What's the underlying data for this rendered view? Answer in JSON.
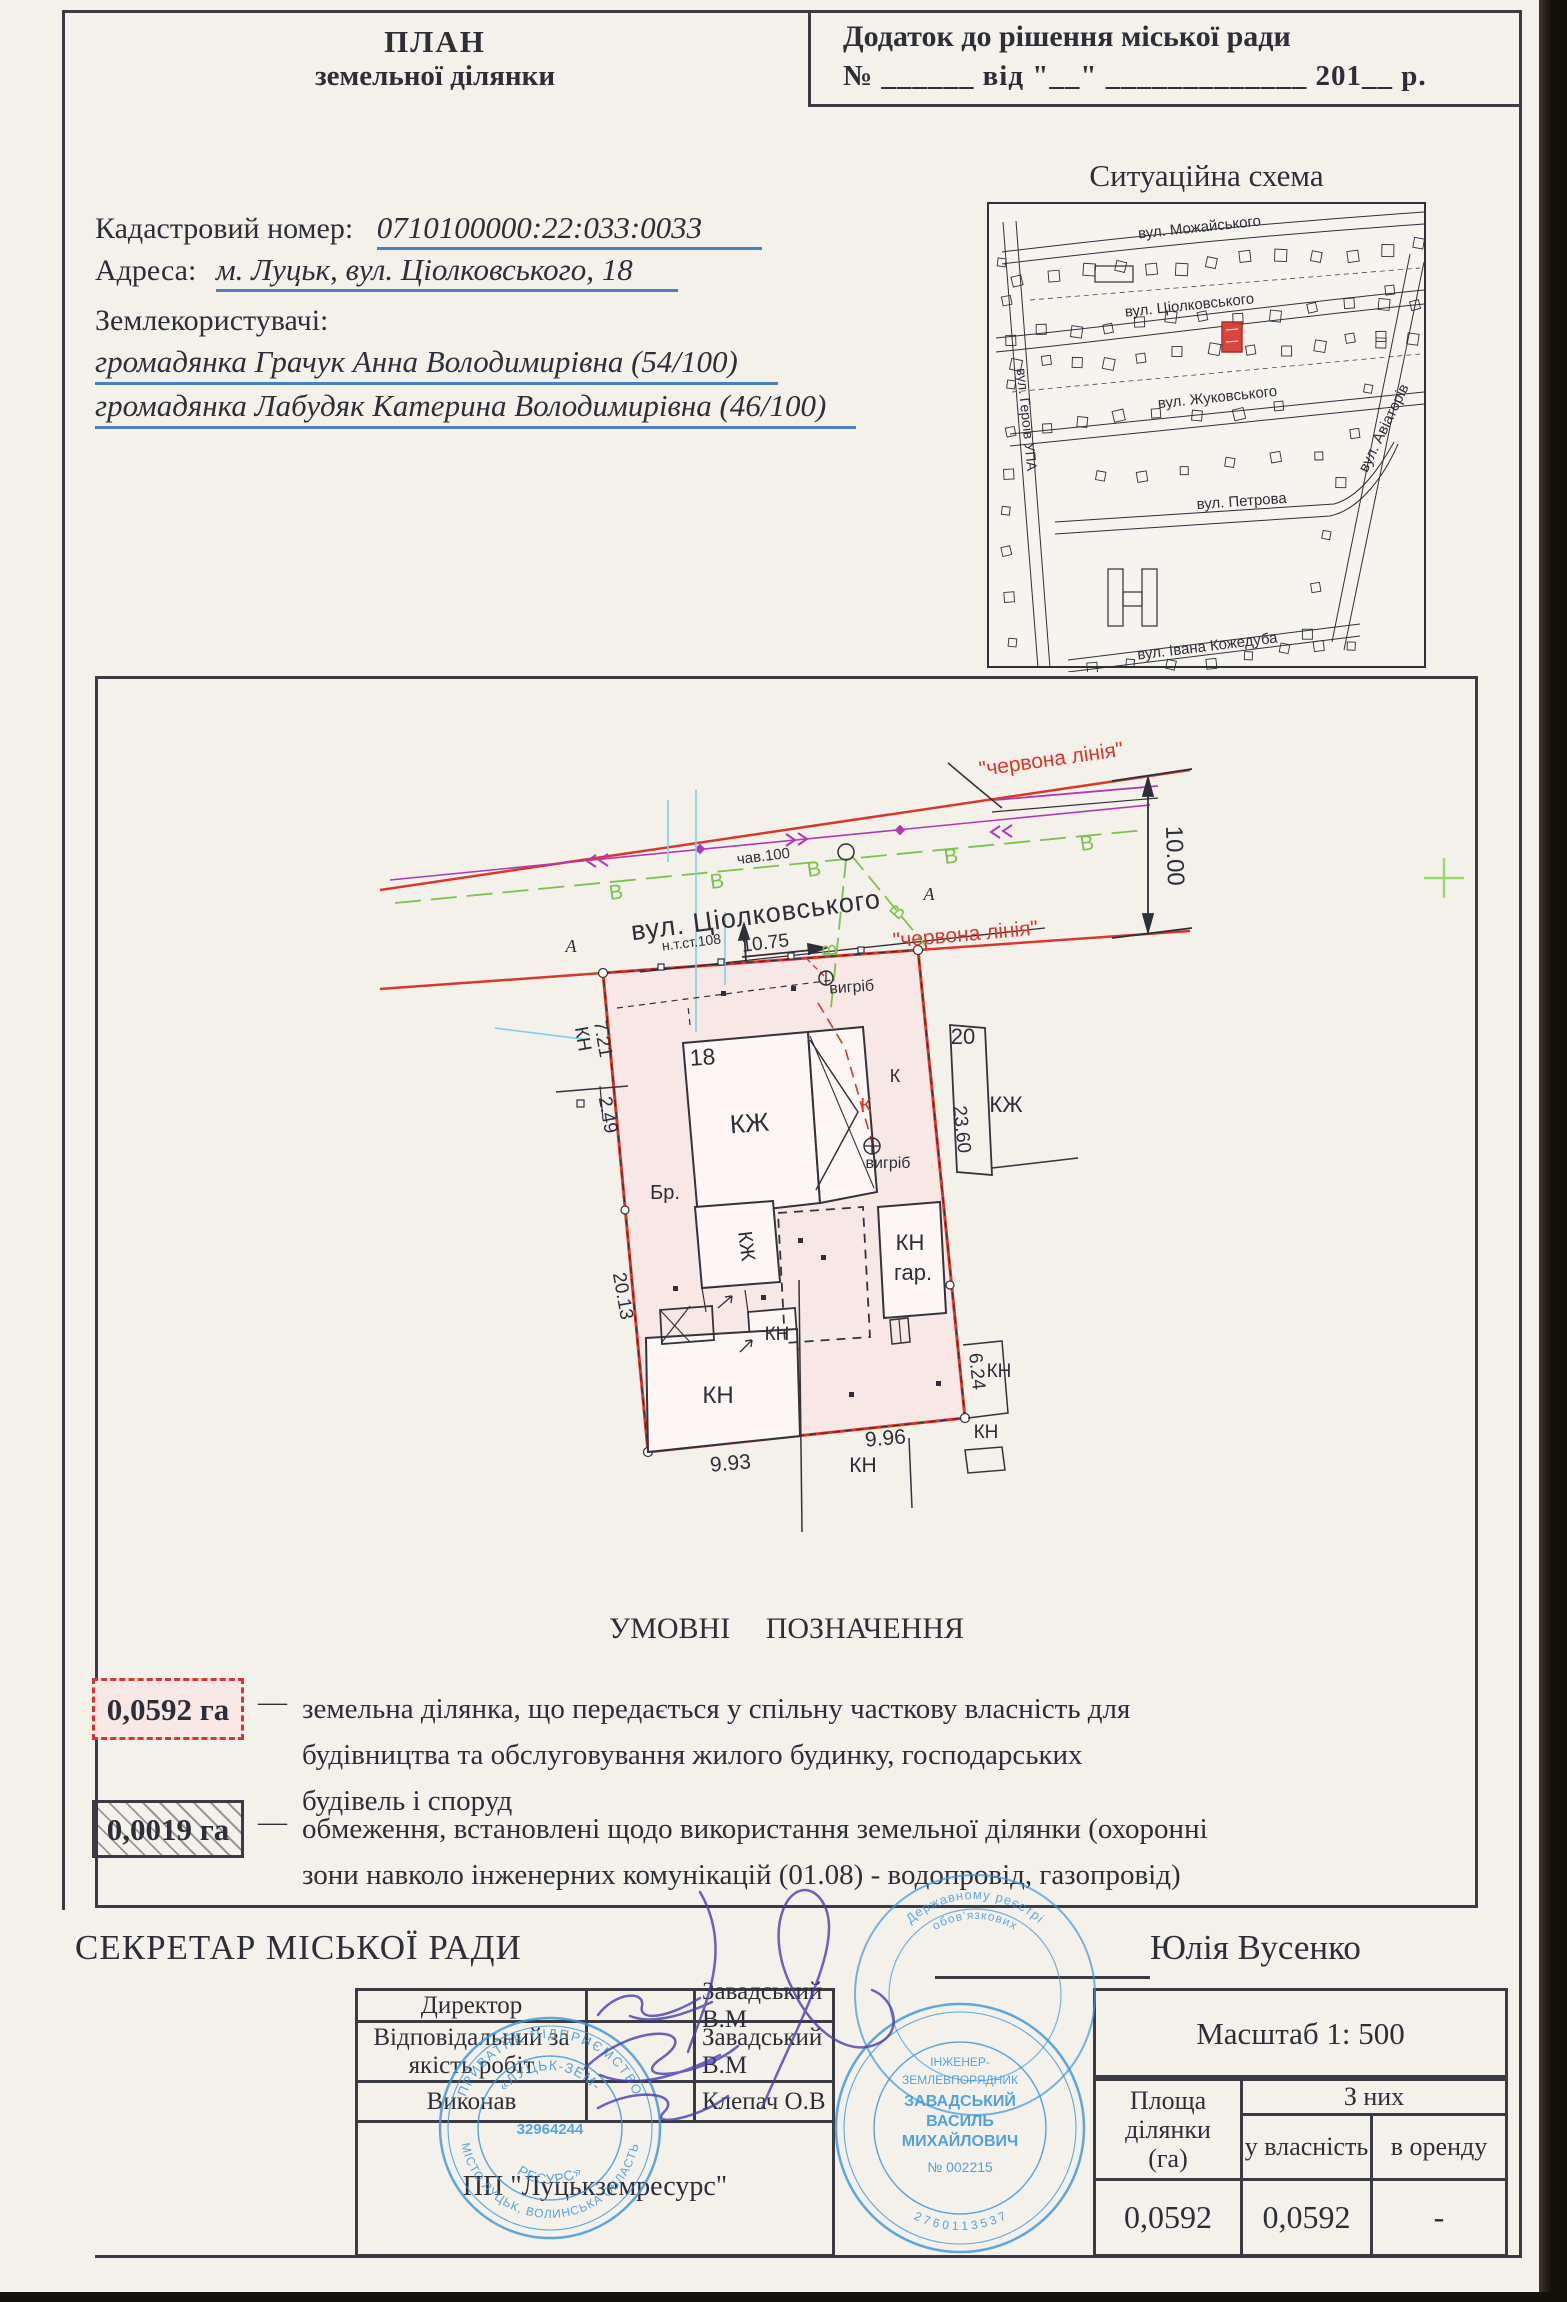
{
  "colors": {
    "red": "#d8382c",
    "green": "#7cc24e",
    "blue": "#4d7fc0",
    "ink": "#2e2e38",
    "line": "#3b3b45",
    "stampblue": "#3f97d8",
    "sigviolet": "#4a3cae",
    "pink": "#f7e7e5"
  },
  "header": {
    "title1": "ПЛАН",
    "title2": "земельної ділянки",
    "appendix1": "Додаток до рішення  міської ради",
    "appendix2": "№ ______ від \"__\" _____________ 201__ р."
  },
  "info": {
    "cadastral_label": "Кадастровий номер:",
    "cadastral_value": "0710100000:22:033:0033",
    "address_label": "Адреса:",
    "address_value": "м. Луцьк, вул. Ціолковського, 18",
    "landusers_label": "Землекористувачі:",
    "landuser1": "громадянка Грачук Анна Володимирівна (54/100)",
    "landuser2": "громадянка Лабудяк Катерина Володимирівна (46/100)"
  },
  "scheme": {
    "title": "Ситуаційна схема",
    "labels": [
      {
        "t": "вул. Можайського",
        "x": 1200,
        "y": 232,
        "r": -6,
        "s": 15,
        "n": "street-mozhayskogo"
      },
      {
        "t": "вул. Ціолковського",
        "x": 1190,
        "y": 310,
        "r": -6,
        "s": 15,
        "n": "street-tsiolkovskogo"
      },
      {
        "t": "вул. Жуковського",
        "x": 1218,
        "y": 402,
        "r": -6,
        "s": 15,
        "n": "street-zhukovskogo"
      },
      {
        "t": "вул. Петрова",
        "x": 1242,
        "y": 506,
        "r": -4,
        "s": 15,
        "n": "street-petrova"
      },
      {
        "t": "вул. Івана Кожедуба",
        "x": 1208,
        "y": 651,
        "r": -7,
        "s": 15,
        "n": "street-kozheduba"
      },
      {
        "t": "вул. Героїв УПА",
        "x": 1022,
        "y": 420,
        "r": 84,
        "s": 14,
        "n": "street-geroiv-upa"
      },
      {
        "t": "вул. Авіаторів",
        "x": 1388,
        "y": 430,
        "r": -64,
        "s": 15,
        "n": "street-aviatoriv"
      }
    ]
  },
  "plan": {
    "labels": [
      {
        "t": "\"червона лінія\"",
        "x": 1052,
        "y": 766,
        "r": -8,
        "s": 21,
        "c": "red",
        "n": "red-line-label-top"
      },
      {
        "t": "\"червона лінія\"",
        "x": 966,
        "y": 941,
        "r": -5,
        "s": 21,
        "c": "red",
        "n": "red-line-label-bottom"
      },
      {
        "t": "10.00",
        "x": 1167,
        "y": 856,
        "r": 88,
        "s": 24,
        "n": "dim-10-00"
      },
      {
        "t": "вул. Ціолковського",
        "x": 757,
        "y": 924,
        "r": -7.5,
        "s": 27,
        "ls": 1,
        "n": "plan-street-name"
      },
      {
        "t": "чав.100",
        "x": 764,
        "y": 861,
        "r": -7,
        "s": 15,
        "n": "pipe-label"
      },
      {
        "t": "н.т.ст.108",
        "x": 692,
        "y": 947,
        "r": -7,
        "s": 14,
        "n": "net-station-label"
      },
      {
        "t": "10.75",
        "x": 766,
        "y": 949,
        "r": -7,
        "s": 19,
        "n": "dim-10-75"
      },
      {
        "t": "А",
        "x": 571,
        "y": 952,
        "s": 18,
        "i": 1,
        "f": "serif",
        "n": "point-a"
      },
      {
        "t": "А",
        "x": 929,
        "y": 900,
        "s": 18,
        "i": 1,
        "f": "serif",
        "n": "point-a"
      },
      {
        "t": "В",
        "x": 617,
        "y": 899,
        "r": -8,
        "s": 21,
        "c": "green",
        "n": "water-mark"
      },
      {
        "t": "В",
        "x": 718,
        "y": 888,
        "r": -8,
        "s": 21,
        "c": "green",
        "n": "water-mark"
      },
      {
        "t": "В",
        "x": 815,
        "y": 876,
        "r": -8,
        "s": 21,
        "c": "green",
        "n": "water-mark"
      },
      {
        "t": "В",
        "x": 952,
        "y": 863,
        "r": -8,
        "s": 21,
        "c": "green",
        "n": "water-mark"
      },
      {
        "t": "В",
        "x": 1088,
        "y": 850,
        "r": -8,
        "s": 21,
        "c": "green",
        "n": "water-mark"
      },
      {
        "t": "В",
        "x": 836,
        "y": 950,
        "r": -90,
        "s": 19,
        "c": "green",
        "n": "water-mark"
      },
      {
        "t": "В",
        "x": 902,
        "y": 916,
        "r": -48,
        "s": 19,
        "c": "green",
        "n": "water-mark"
      },
      {
        "t": "вигріб",
        "x": 852,
        "y": 992,
        "r": -4,
        "s": 16,
        "n": "cesspool-label"
      },
      {
        "t": "вигріб",
        "x": 888,
        "y": 1168,
        "s": 16,
        "n": "cesspool-label"
      },
      {
        "t": "К",
        "x": 866,
        "y": 1112,
        "s": 20,
        "c": "red",
        "n": "sewer-mark"
      },
      {
        "t": "К",
        "x": 895,
        "y": 1082,
        "s": 18,
        "n": "sewer-mark"
      },
      {
        "t": "18",
        "x": 703,
        "y": 1065,
        "r": -4,
        "s": 23,
        "n": "house-number"
      },
      {
        "t": "КЖ",
        "x": 750,
        "y": 1132,
        "r": -4,
        "s": 26,
        "n": "building-label"
      },
      {
        "t": "КЖ",
        "x": 740,
        "y": 1247,
        "r": 83,
        "s": 20,
        "n": "building-label"
      },
      {
        "t": "Бр.",
        "x": 665,
        "y": 1199,
        "s": 20,
        "n": "pavement-label"
      },
      {
        "t": "КН",
        "x": 777,
        "y": 1340,
        "s": 19,
        "n": "building-label"
      },
      {
        "t": "КН",
        "x": 910,
        "y": 1250,
        "s": 22,
        "n": "building-label"
      },
      {
        "t": "гар.",
        "x": 913,
        "y": 1280,
        "s": 22,
        "n": "garage-label"
      },
      {
        "t": "КН",
        "x": 718,
        "y": 1403,
        "s": 24,
        "n": "building-label"
      },
      {
        "t": "20",
        "x": 963,
        "y": 1044,
        "s": 22,
        "n": "house-number"
      },
      {
        "t": "23.60",
        "x": 956,
        "y": 1130,
        "r": 84,
        "s": 19,
        "n": "dim"
      },
      {
        "t": "КЖ",
        "x": 1006,
        "y": 1112,
        "s": 22,
        "n": "building-label"
      },
      {
        "t": "7.21",
        "x": 597,
        "y": 1040,
        "r": 80,
        "s": 19,
        "n": "dim"
      },
      {
        "t": "КН",
        "x": 577,
        "y": 1040,
        "r": 80,
        "s": 19,
        "n": "building-label"
      },
      {
        "t": "2.49",
        "x": 602,
        "y": 1116,
        "r": 80,
        "s": 19,
        "n": "dim"
      },
      {
        "t": "20.13",
        "x": 617,
        "y": 1297,
        "r": 80,
        "s": 19,
        "n": "dim"
      },
      {
        "t": "6.24",
        "x": 971,
        "y": 1372,
        "r": 84,
        "s": 19,
        "n": "dim"
      },
      {
        "t": "КН",
        "x": 999,
        "y": 1377,
        "s": 19,
        "n": "building-label"
      },
      {
        "t": "9.93",
        "x": 731,
        "y": 1470,
        "r": -5,
        "s": 21,
        "n": "dim"
      },
      {
        "t": "КН",
        "x": 863,
        "y": 1472,
        "s": 21,
        "n": "building-label"
      },
      {
        "t": "9.96",
        "x": 886,
        "y": 1445,
        "r": -5,
        "s": 21,
        "n": "dim"
      },
      {
        "t": "КН",
        "x": 986,
        "y": 1438,
        "s": 19,
        "n": "building-label"
      }
    ]
  },
  "legend": {
    "title": "УМОВНІ ПОЗНАЧЕННЯ",
    "dash": "—",
    "items": [
      {
        "value": "0,0592 га",
        "lines": [
          "земельна ділянка, що передається у спільну часткову власність для",
          "будівництва та обслуговування жилого будинку, господарських",
          "будівель і споруд"
        ]
      },
      {
        "value": "0,0019 га",
        "lines": [
          "обмеження, встановлені щодо використання земельної ділянки (охоронні",
          "зони навколо інженерних комунікацій (01.08) - водопровід, газопровід)"
        ]
      }
    ]
  },
  "footer": {
    "secretary_label": "СЕКРЕТАР МІСЬКОЇ РАДИ",
    "secretary_name": "Юлія Вусенко",
    "sign_rows": [
      {
        "role": "Директор",
        "name": "Завадський В.М"
      },
      {
        "role": "Відповідальний за якість робіт",
        "name": "Завадський В.М"
      },
      {
        "role": "Виконав",
        "name": "Клепач О.В"
      }
    ],
    "company": "ПП \"Луцькземресурс\"",
    "scale": "Масштаб  1: 500",
    "area": {
      "col_area": "Площа ділянки (га)",
      "col_group": "З них",
      "col_own": "у власність",
      "col_rent": "в оренду",
      "values": [
        "0,0592",
        "0,0592",
        "-"
      ]
    }
  },
  "stamps": {
    "company": {
      "ring_top": "ПРИВАТНЕ ПІДПРИЄМСТВО",
      "inner_top": "«ЛУЦЬК-ЗЕМ-",
      "inner_bottom": "РЕСУРС»",
      "code": "32964244",
      "ring_bottom": "МІСТО ЛУЦЬК, ВОЛИНСЬКА ОБЛАСТЬ"
    },
    "registry": {
      "arc1": "Державному реєстрі",
      "arc2": "обов'язкових"
    },
    "engineer": {
      "line1": "ІНЖЕНЕР-",
      "line2": "ЗЕМЛЕВПОРЯДНИК",
      "line3": "ЗАВАДСЬКИЙ",
      "line4": "ВАСИЛЬ",
      "line5": "МИХАЙЛОВИЧ",
      "line6": "№ 002215",
      "digits": "2 7 6 0 1 1 3 5 3 7"
    }
  }
}
